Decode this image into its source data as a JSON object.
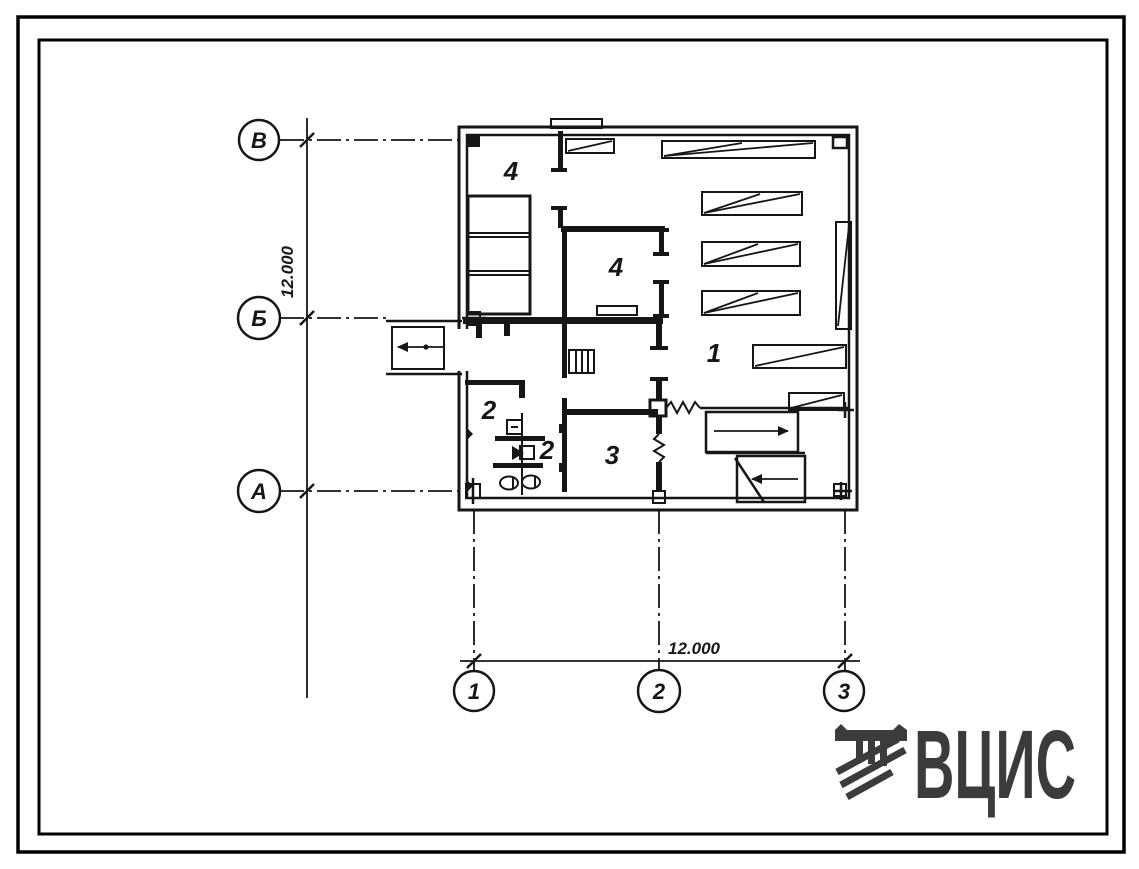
{
  "sheet": {
    "background": "#ffffff",
    "frame_color": "#000000",
    "ink_color": "#161616"
  },
  "plan": {
    "row_axes": [
      {
        "label": "В"
      },
      {
        "label": "Б"
      },
      {
        "label": "А"
      }
    ],
    "column_axes": [
      {
        "label": "1"
      },
      {
        "label": "2"
      },
      {
        "label": "3"
      }
    ],
    "dimensions": {
      "vertical": "12.000",
      "horizontal": "12.000"
    },
    "room_labels": [
      {
        "room": "4"
      },
      {
        "room": "4"
      },
      {
        "room": "1"
      },
      {
        "room": "2"
      },
      {
        "room": "2"
      },
      {
        "room": "3"
      }
    ]
  },
  "logo": {
    "text": "ВЦИС",
    "icon": "vcis-emblem-icon",
    "color": "#3b3b3d"
  }
}
